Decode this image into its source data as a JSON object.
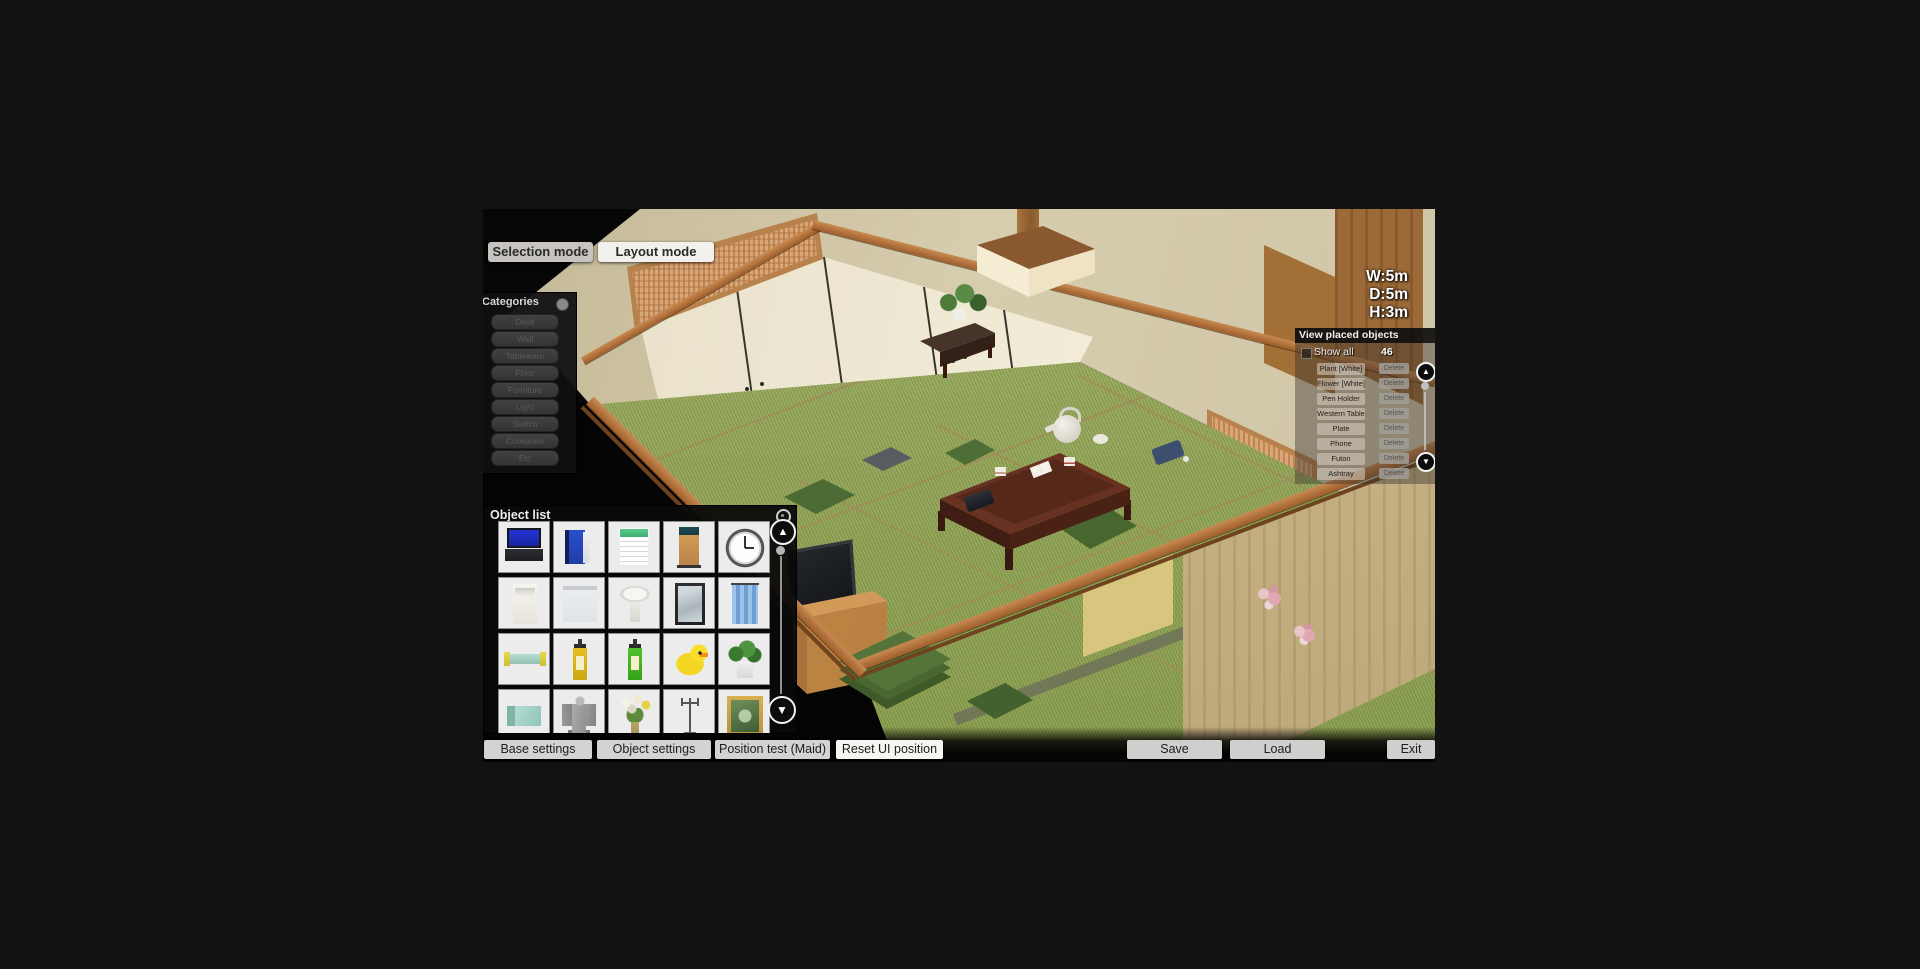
{
  "top_bar": {
    "selection_mode": "Selection mode",
    "layout_mode": "Layout mode"
  },
  "room_info": {
    "width": "W:5m",
    "depth": "D:5m",
    "height": "H:3m"
  },
  "categories_panel": {
    "title": "Categories",
    "buttons": [
      "Desk",
      "Wall",
      "Tableware",
      "Floor",
      "Furniture",
      "Light",
      "Switch",
      "Cookware",
      "Etc"
    ]
  },
  "object_list_panel": {
    "title": "Object list",
    "items": [
      "Laptop",
      "Blue book",
      "Calendar",
      "Partition",
      "Wall clock",
      "Hanging scroll",
      "White panel",
      "Wash basin",
      "Mirror",
      "Blue curtain",
      "Glass shelf",
      "Pump bottle (yellow)",
      "Pump bottle (green)",
      "Rubber duck",
      "Potted plant",
      "Wall shelf",
      "Angel statue",
      "Flower bouquet",
      "Candle stand",
      "Framed painting"
    ]
  },
  "placed_objects_panel": {
    "title": "View placed objects",
    "show_all_label": "Show all",
    "count": "46",
    "delete_label": "Delete",
    "rows": [
      "Plant [White]",
      "Flower [White]",
      "Pen Holder",
      "Western Table",
      "Plate",
      "Phone",
      "Futon",
      "Ashtray"
    ]
  },
  "bottom_bar": {
    "base_settings": "Base settings",
    "object_settings": "Object settings",
    "position_test": "Position test (Maid)",
    "reset_ui": "Reset UI position",
    "save": "Save",
    "load": "Load",
    "exit": "Exit"
  },
  "scene": {
    "room_type": "Japanese tatami room",
    "objects": [
      "tatami floor",
      "low wooden table",
      "tea kettle",
      "tea cups",
      "open book",
      "tablet",
      "green floor cushions",
      "gray floor cushion",
      "television",
      "wood cabinet",
      "cushion stack",
      "potted plant on shelf",
      "hanging ceiling lamp",
      "sliding fusuma doors",
      "transom lattice",
      "wood wardrobe",
      "lattice screen",
      "flower prints"
    ]
  }
}
